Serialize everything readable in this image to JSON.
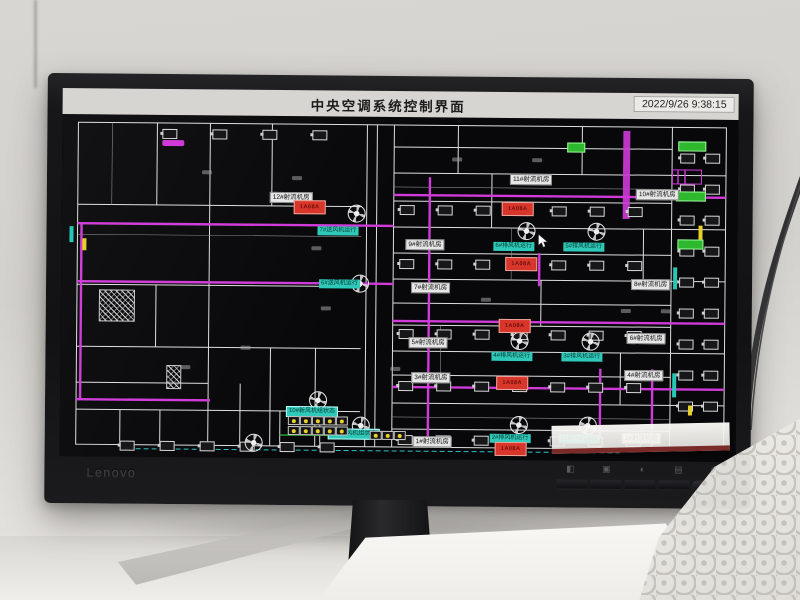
{
  "screen": {
    "title": "中央空调系统控制界面",
    "timestamp": "2022/9/26 9:38:15"
  },
  "monitor": {
    "brand": "Lenovo",
    "buttons": [
      {
        "name": "nav-icon",
        "glyph": "◧"
      },
      {
        "name": "input-source-icon",
        "glyph": "▣"
      },
      {
        "name": "brightness-icon",
        "glyph": "◐"
      },
      {
        "name": "menu-icon",
        "glyph": "▤"
      },
      {
        "name": "power-icon",
        "glyph": "◉"
      }
    ]
  },
  "colors": {
    "duct": "#cf3ad8",
    "walls": "#dedede",
    "alarm": "#d8352b",
    "teal": "#2fc9b9",
    "green": "#2db82d",
    "yellow": "#e8d02a",
    "screen_bg": "#08080a",
    "titlebar": "#d7d5d1"
  },
  "plan": {
    "room_labels": [
      {
        "t": "12#射流机房",
        "x": 208,
        "y": 76
      },
      {
        "t": "11#射流机房",
        "x": 448,
        "y": 56
      },
      {
        "t": "10#射流机房",
        "x": 574,
        "y": 70
      },
      {
        "t": "9#射流机房",
        "x": 344,
        "y": 122
      },
      {
        "t": "8#射流机房",
        "x": 570,
        "y": 160
      },
      {
        "t": "7#射流机房",
        "x": 350,
        "y": 165
      },
      {
        "t": "6#射流机房",
        "x": 566,
        "y": 214
      },
      {
        "t": "5#射流机房",
        "x": 348,
        "y": 220
      },
      {
        "t": "4#射流机房",
        "x": 564,
        "y": 251
      },
      {
        "t": "3#射流机房",
        "x": 351,
        "y": 255
      },
      {
        "t": "2#射流机房",
        "x": 562,
        "y": 314
      },
      {
        "t": "1#射流机房",
        "x": 353,
        "y": 319
      }
    ],
    "run_labels": [
      {
        "t": "7#送风机运行",
        "x": 256,
        "y": 110
      },
      {
        "t": "6#送风机运行",
        "x": 258,
        "y": 163
      },
      {
        "t": "6#排风机运行",
        "x": 432,
        "y": 124
      },
      {
        "t": "5#排风机运行",
        "x": 502,
        "y": 124
      },
      {
        "t": "4#排风机运行",
        "x": 431,
        "y": 234
      },
      {
        "t": "3#排风机运行",
        "x": 501,
        "y": 234
      },
      {
        "t": "2#排风机运行",
        "x": 430,
        "y": 316
      },
      {
        "t": "1#排风机运行",
        "x": 499,
        "y": 316
      }
    ],
    "banners": [
      {
        "t": "10#新风机组状态",
        "x": 226,
        "y": 290
      },
      {
        "t": "11#新风机组状态",
        "x": 268,
        "y": 312
      }
    ],
    "alarms": [
      {
        "t": "1A08A",
        "x": 232,
        "y": 84
      },
      {
        "t": "1A08A",
        "x": 440,
        "y": 84
      },
      {
        "t": "1A08A",
        "x": 444,
        "y": 139
      },
      {
        "t": "1A08A",
        "x": 438,
        "y": 201
      },
      {
        "t": "1A08A",
        "x": 436,
        "y": 258
      },
      {
        "t": "1A08A",
        "x": 435,
        "y": 324
      }
    ],
    "fans": [
      [
        286,
        88
      ],
      [
        290,
        158
      ],
      [
        456,
        104
      ],
      [
        526,
        104
      ],
      [
        450,
        214
      ],
      [
        521,
        214
      ],
      [
        450,
        298
      ],
      [
        519,
        298
      ],
      [
        249,
        275
      ],
      [
        292,
        300
      ],
      [
        185,
        318
      ]
    ],
    "equip_rows": [
      {
        "y": 88,
        "x0": 338,
        "n": 7,
        "dx": 38
      },
      {
        "y": 142,
        "x0": 338,
        "n": 7,
        "dx": 38
      },
      {
        "y": 212,
        "x0": 338,
        "n": 7,
        "dx": 38
      },
      {
        "y": 264,
        "x0": 338,
        "n": 7,
        "dx": 38
      },
      {
        "y": 318,
        "x0": 338,
        "n": 7,
        "dx": 38
      },
      {
        "y": 326,
        "x0": 60,
        "n": 6,
        "dx": 40
      },
      {
        "y": 14,
        "x0": 100,
        "n": 4,
        "dx": 50
      }
    ],
    "equip_cols": [
      {
        "x": 618,
        "y0": 34,
        "n": 9,
        "dy": 31
      },
      {
        "x": 643,
        "y0": 34,
        "n": 9,
        "dy": 31
      }
    ],
    "green_boxes": [
      {
        "x": 616,
        "y": 22,
        "w": 26
      },
      {
        "x": 614,
        "y": 72,
        "w": 28
      },
      {
        "x": 616,
        "y": 120,
        "w": 24
      },
      {
        "x": 505,
        "y": 24,
        "w": 16
      }
    ],
    "magenta_pills": [
      {
        "x": 100,
        "y": 25
      }
    ],
    "yellow_ticks": [
      {
        "x": 637,
        "y": 106,
        "h": 14
      },
      {
        "x": 628,
        "y": 286,
        "h": 10
      },
      {
        "x": 21,
        "y": 124,
        "h": 12
      }
    ],
    "teal_bars": [
      {
        "x": 612,
        "y": 148,
        "h": 22
      },
      {
        "x": 612,
        "y": 254,
        "h": 24
      },
      {
        "x": 8,
        "y": 112,
        "h": 16
      }
    ],
    "hatches": [
      {
        "x": 38,
        "y": 175,
        "w": 34,
        "h": 30
      },
      {
        "x": 106,
        "y": 250,
        "w": 13,
        "h": 22
      }
    ],
    "machines": [
      {
        "x": 610,
        "y": 50,
        "w": 28,
        "h": 13
      }
    ],
    "marks": [
      [
        140,
        55
      ],
      [
        230,
        60
      ],
      [
        120,
        250
      ],
      [
        260,
        190
      ],
      [
        390,
        40
      ],
      [
        470,
        40
      ],
      [
        560,
        190
      ],
      [
        250,
        130
      ],
      [
        180,
        230
      ],
      [
        330,
        250
      ],
      [
        420,
        180
      ],
      [
        600,
        190
      ]
    ],
    "dot_panels": [
      {
        "x": 228,
        "y": 300,
        "cols": 5,
        "rows": 2
      },
      {
        "x": 310,
        "y": 314,
        "cols": 3,
        "rows": 1
      }
    ],
    "cursor": {
      "x": 476,
      "y": 116
    }
  }
}
